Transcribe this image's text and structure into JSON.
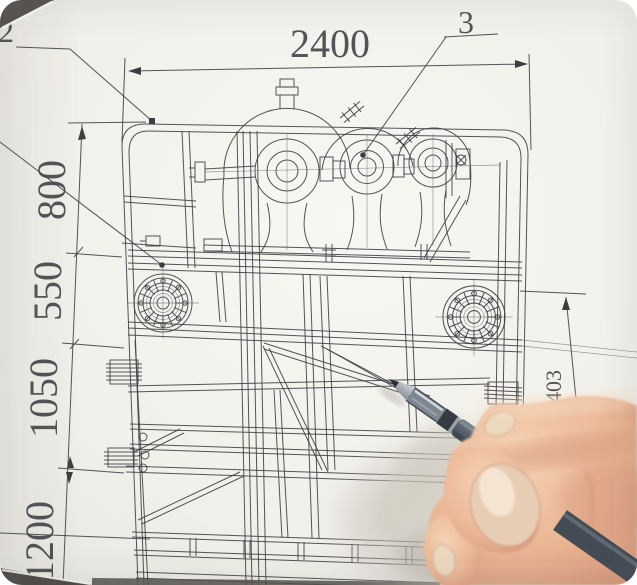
{
  "drawing": {
    "dimensions": {
      "top_width": "2400",
      "left_chain": [
        "800",
        "550",
        "1050",
        "1200"
      ],
      "right_height": "1403"
    },
    "callouts": {
      "left": "2",
      "right": "3"
    }
  },
  "colors": {
    "paper": "#f3f2ee",
    "ink": "#3d3c41",
    "desk": "#55524d",
    "pen_barrel": "#5a636e",
    "pen_grip": "#7d8790",
    "skin": "#e9b897",
    "nail": "#ecd8bf"
  }
}
